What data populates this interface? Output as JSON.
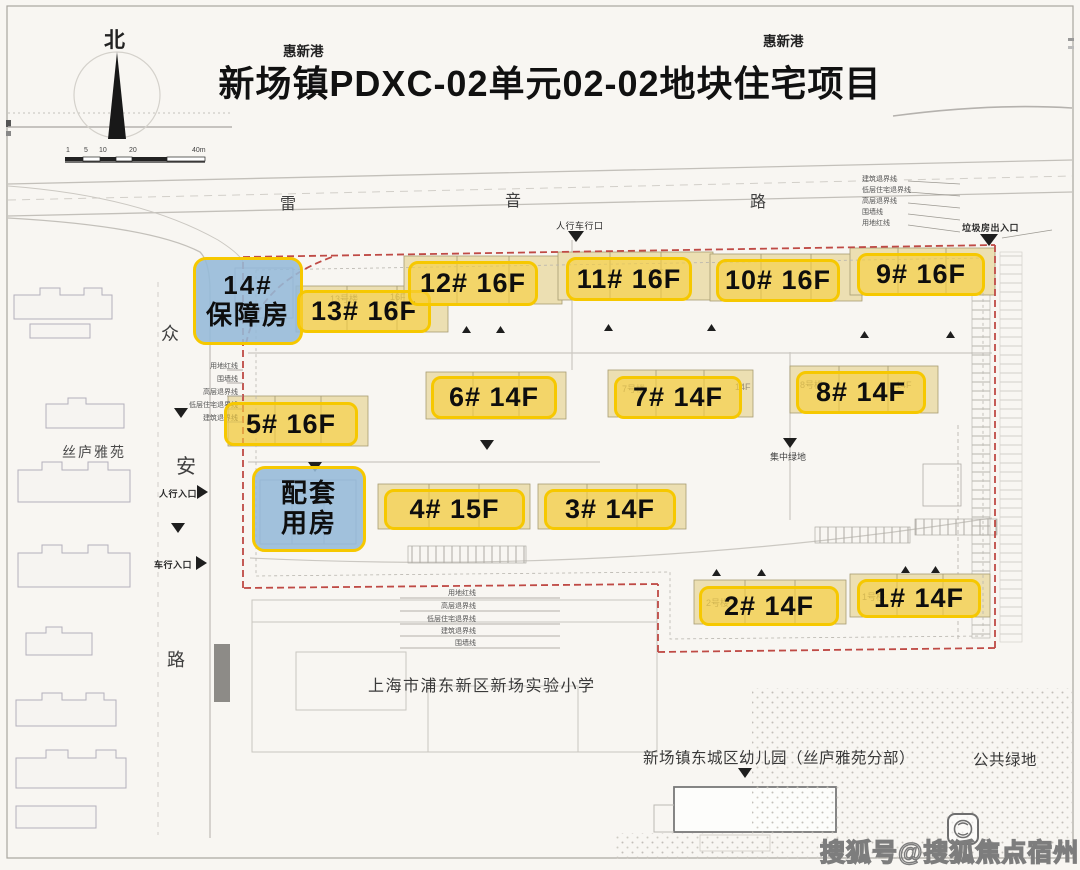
{
  "page": {
    "title": "新场镇PDXC-02单元02-02地块住宅项目",
    "canal_left": "惠新港",
    "canal_right": "惠新港"
  },
  "compass": {
    "north": "北"
  },
  "scale_bar": {
    "ticks": [
      "1",
      "5",
      "10",
      "20",
      "40m"
    ]
  },
  "streets": {
    "top": [
      "雷",
      "音",
      "路"
    ],
    "west": [
      "众",
      "安",
      "路"
    ]
  },
  "places": {
    "west_estate": "丝庐雅苑",
    "school": "上海市浦东新区新场实验小学",
    "kindergarten": "新场镇东城区幼儿园（丝庐雅苑分部）",
    "public_green": "公共绿地",
    "central_green": "集中绿地"
  },
  "entrances": [
    {
      "label": "人行车行口"
    },
    {
      "label": "垃圾房出入口"
    },
    {
      "label": "人行入口"
    },
    {
      "label": "车行入口"
    }
  ],
  "boundary_legend": {
    "left": [
      "用地红线",
      "围墙线",
      "高层退界线",
      "低层住宅退界线",
      "建筑退界线"
    ],
    "right": [
      "建筑退界线",
      "低层住宅退界线",
      "高层退界线",
      "围墙线",
      "用地红线"
    ],
    "bottom": [
      "用地红线",
      "高层退界线",
      "低层住宅退界线",
      "建筑退界线",
      "围墙线"
    ]
  },
  "buildings": [
    {
      "id": "14",
      "label": "14#",
      "label2": "保障房",
      "type": "affordable"
    },
    {
      "id": "13",
      "label": "13# 16F",
      "type": "residential"
    },
    {
      "id": "12",
      "label": "12# 16F",
      "type": "residential"
    },
    {
      "id": "11",
      "label": "11# 16F",
      "type": "residential"
    },
    {
      "id": "10",
      "label": "10# 16F",
      "type": "residential"
    },
    {
      "id": "9",
      "label": "9# 16F",
      "type": "residential"
    },
    {
      "id": "8",
      "label": "8# 14F",
      "type": "residential"
    },
    {
      "id": "7",
      "label": "7# 14F",
      "type": "residential"
    },
    {
      "id": "6",
      "label": "6# 14F",
      "type": "residential"
    },
    {
      "id": "5",
      "label": "5# 16F",
      "type": "residential"
    },
    {
      "id": "amenity",
      "label": "配套",
      "label2": "用房",
      "type": "amenity"
    },
    {
      "id": "4",
      "label": "4# 15F",
      "type": "residential"
    },
    {
      "id": "3",
      "label": "3# 14F",
      "type": "residential"
    },
    {
      "id": "2",
      "label": "2# 14F",
      "type": "residential"
    },
    {
      "id": "1",
      "label": "1# 14F",
      "type": "residential"
    }
  ],
  "background_marks": [
    "13号楼",
    "16F",
    "16F",
    "7号楼",
    "14F",
    "8号楼",
    "14F",
    "1号楼",
    "2号楼"
  ],
  "watermark": {
    "text": "搜狐号@搜狐焦点宿州站"
  },
  "colors": {
    "highlight_fill": "#f7ce3c",
    "highlight_border": "#f6c800",
    "affordable_fill": "#94bad8",
    "boundary_red": "#bf4a45",
    "paper": "#f8f6f2",
    "map_line": "#b5b2ac"
  }
}
